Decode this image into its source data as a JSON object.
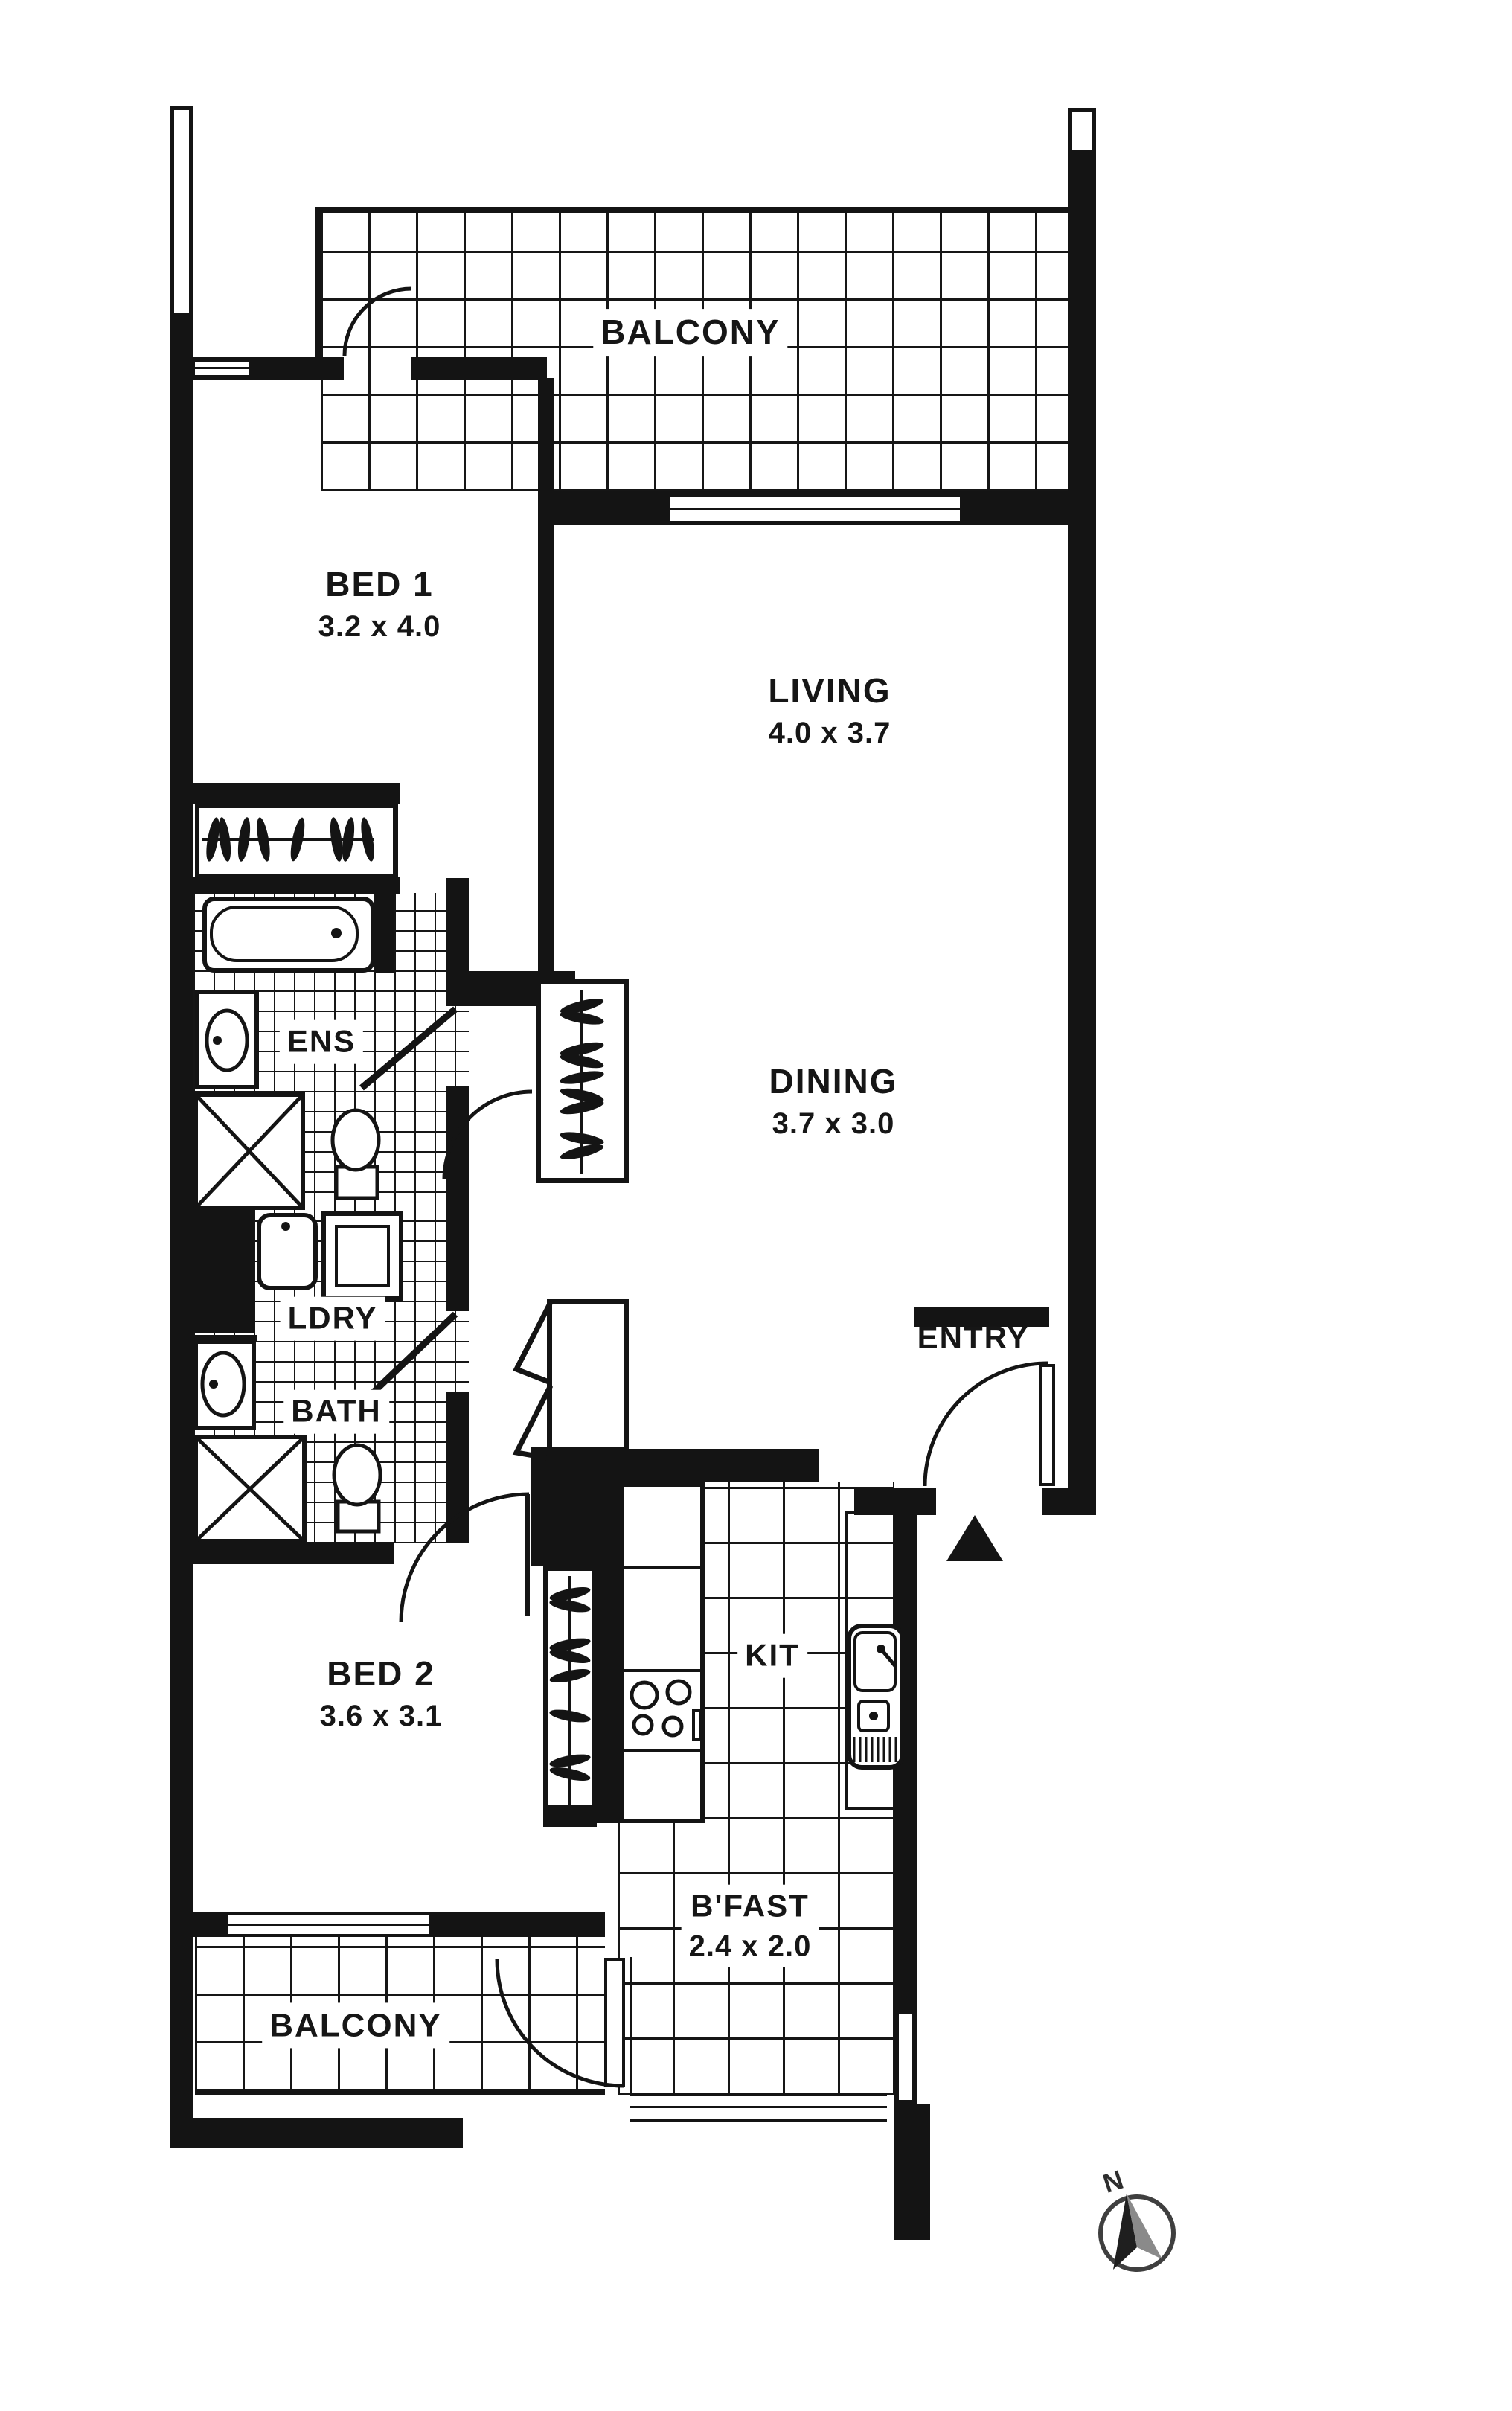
{
  "plan": {
    "balcony_top": {
      "label": "BALCONY"
    },
    "bed1": {
      "label": "BED 1",
      "dims": "3.2 x 4.0"
    },
    "living": {
      "label": "LIVING",
      "dims": "4.0 x 3.7"
    },
    "dining": {
      "label": "DINING",
      "dims": "3.7 x 3.0"
    },
    "ens": {
      "label": "ENS"
    },
    "ldry": {
      "label": "LDRY"
    },
    "bath": {
      "label": "BATH"
    },
    "entry": {
      "label": "ENTRY"
    },
    "bed2": {
      "label": "BED 2",
      "dims": "3.6 x 3.1"
    },
    "kit": {
      "label": "KIT"
    },
    "bfast": {
      "label": "B'FAST",
      "dims": "2.4 x 2.0"
    },
    "balcony_bottom": {
      "label": "BALCONY"
    },
    "compass": {
      "label": "N"
    }
  },
  "colors": {
    "ink": "#141414",
    "paper": "#ffffff",
    "compass_ring": "#3f3f3f"
  }
}
